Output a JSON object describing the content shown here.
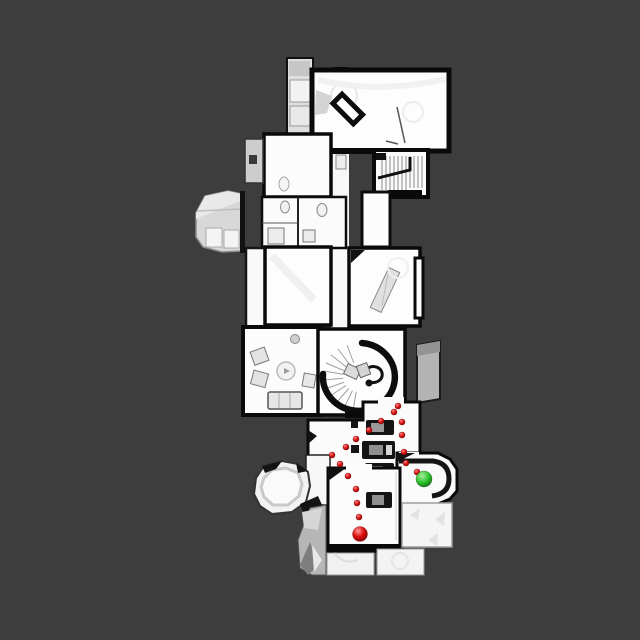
{
  "scene": {
    "type": "top-down-floorplan-navigation-map",
    "background_color": "#3d3d3d",
    "floor_color": "#fbfbfb",
    "wall_color": "#0a0a0a",
    "annex_gray": "#c9c9c9"
  },
  "navigation": {
    "path_dot_color": "#dd1111",
    "path_dot_radius": 3,
    "start_marker": {
      "shape": "sphere",
      "color": "#dd0d0d",
      "x": 360,
      "y": 534,
      "radius": 7.5
    },
    "goal_marker": {
      "shape": "sphere",
      "color": "#2dc22d",
      "x": 424,
      "y": 479,
      "radius": 8
    },
    "path_dots": [
      {
        "x": 359,
        "y": 517
      },
      {
        "x": 357,
        "y": 503
      },
      {
        "x": 356,
        "y": 489
      },
      {
        "x": 348,
        "y": 476
      },
      {
        "x": 340,
        "y": 464
      },
      {
        "x": 332,
        "y": 455
      },
      {
        "x": 346,
        "y": 447
      },
      {
        "x": 356,
        "y": 439
      },
      {
        "x": 369,
        "y": 430
      },
      {
        "x": 381,
        "y": 421
      },
      {
        "x": 394,
        "y": 412
      },
      {
        "x": 398,
        "y": 406
      },
      {
        "x": 402,
        "y": 422
      },
      {
        "x": 402,
        "y": 435
      },
      {
        "x": 404,
        "y": 452
      },
      {
        "x": 406,
        "y": 463
      },
      {
        "x": 417,
        "y": 472
      }
    ]
  }
}
